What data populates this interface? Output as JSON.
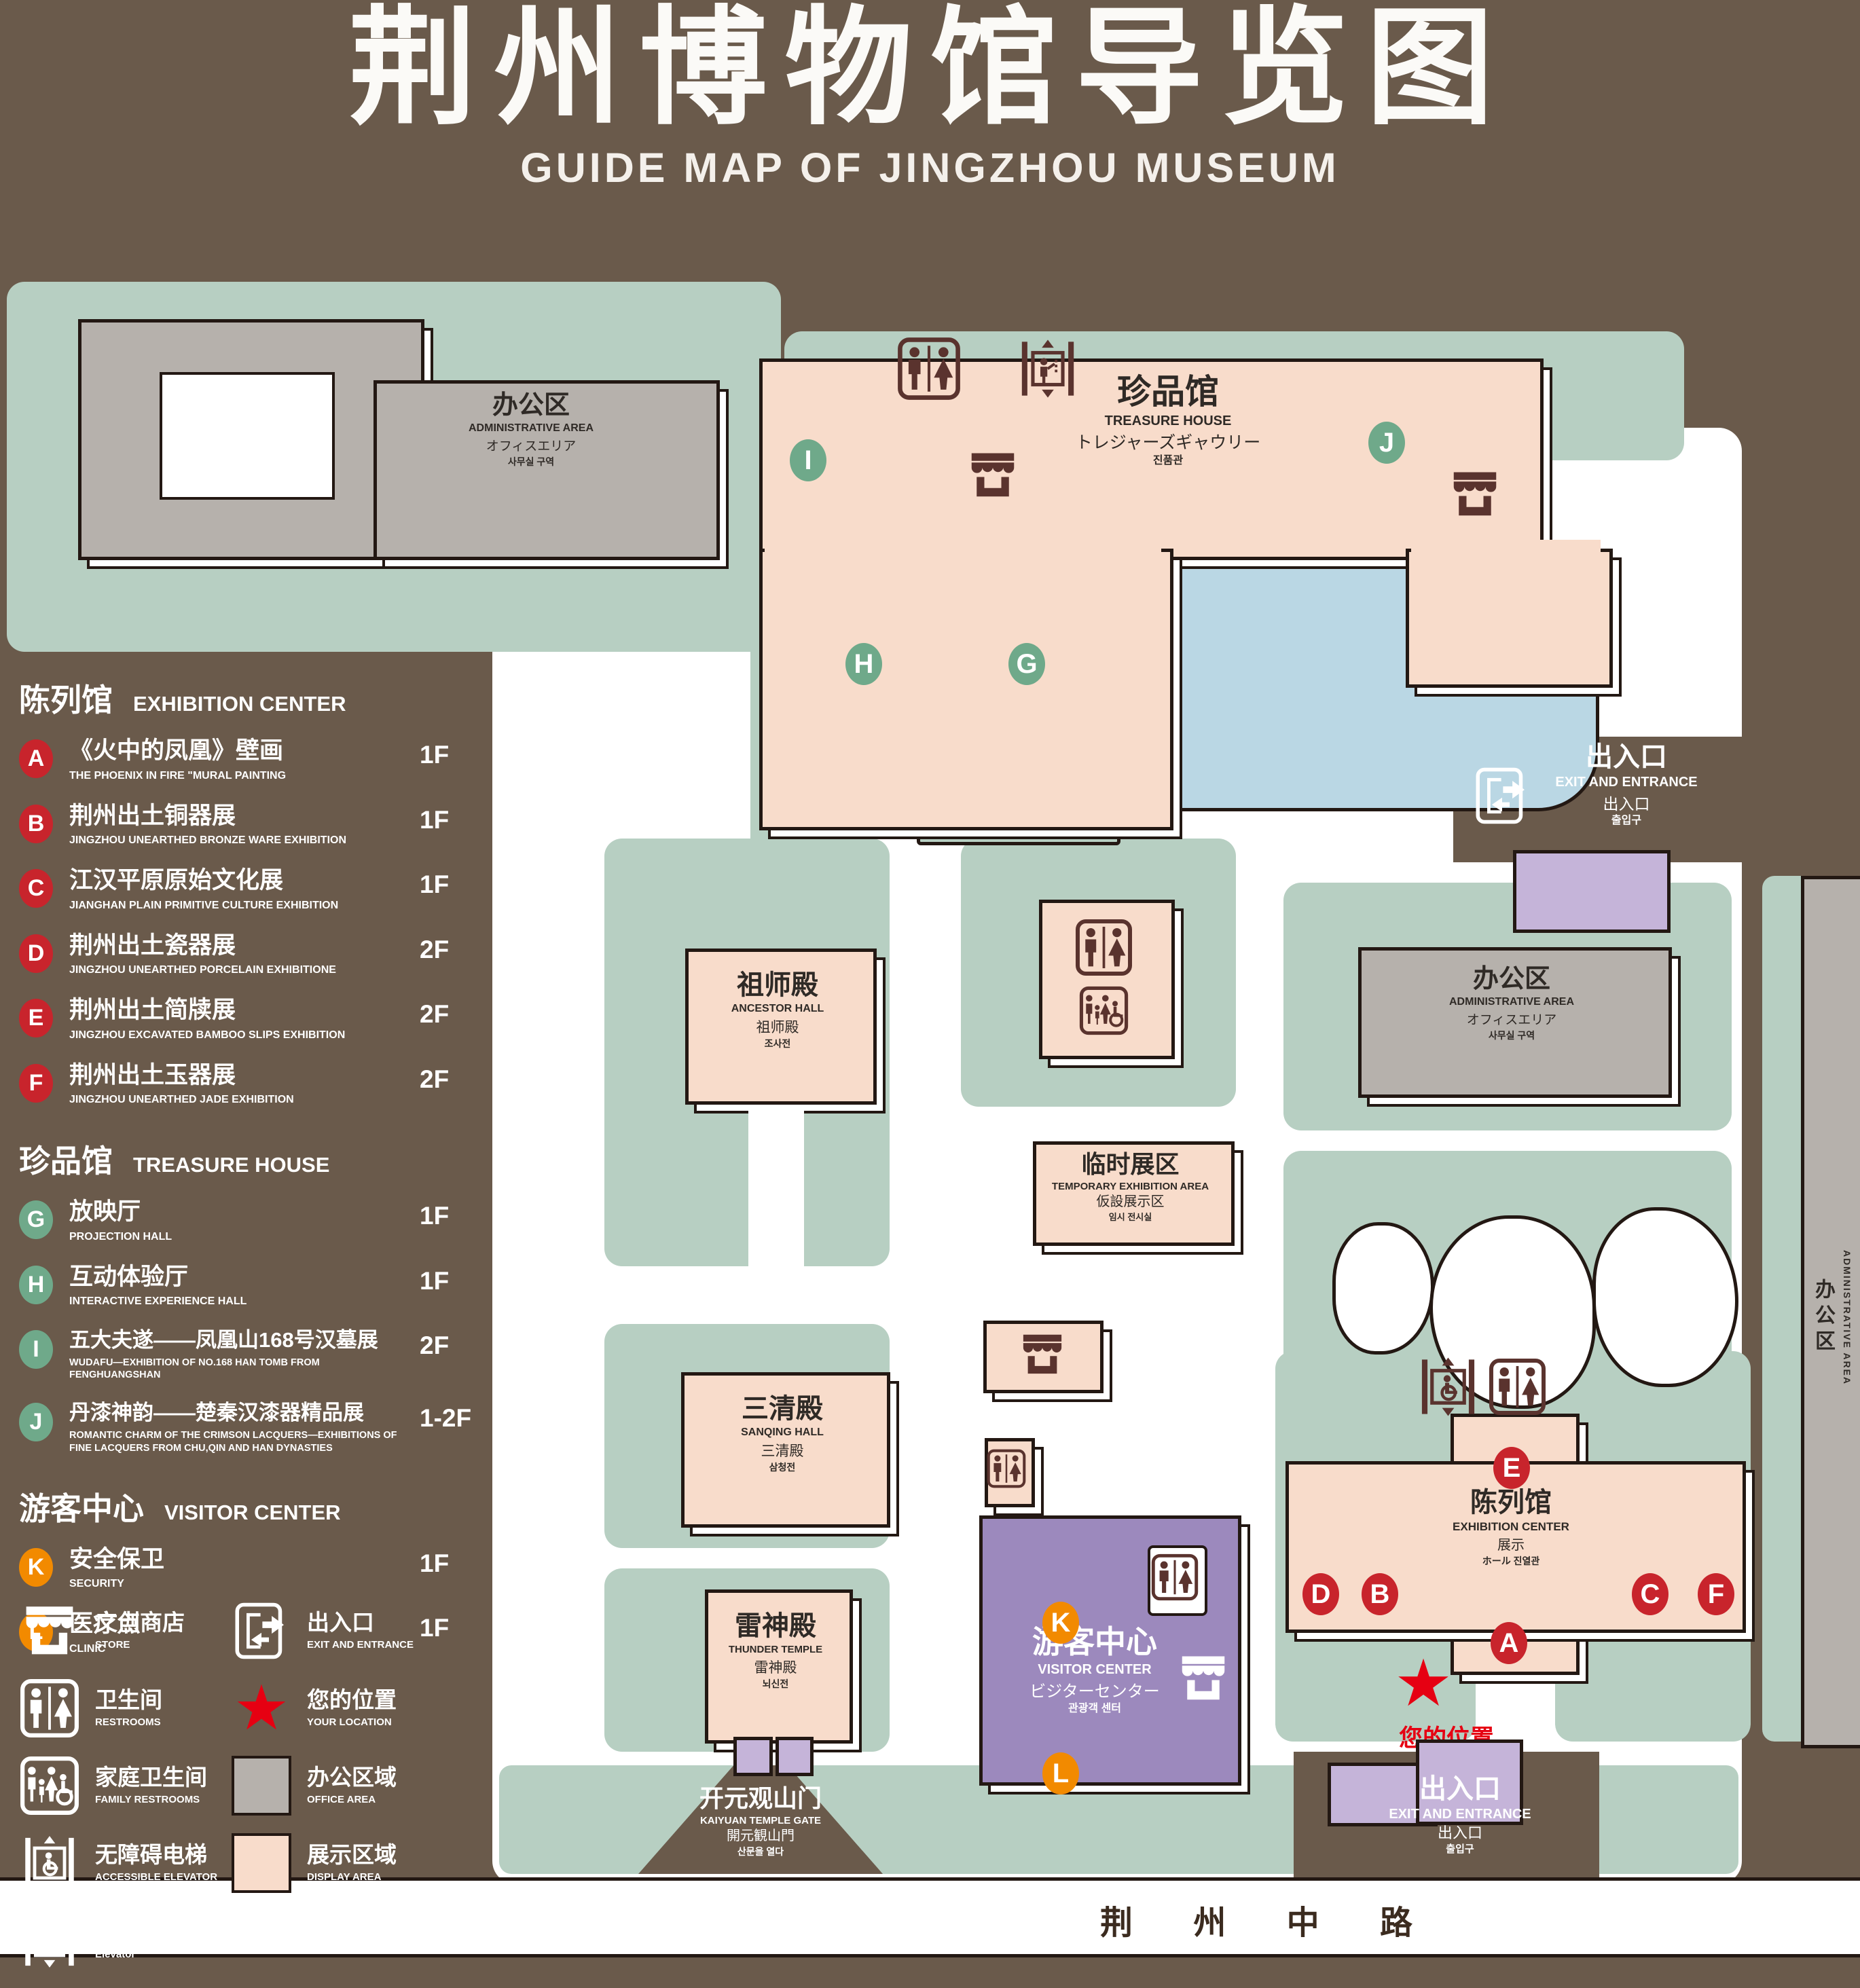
{
  "title": {
    "zh": "荆州博物馆导览图",
    "en": "GUIDE MAP OF JINGZHOU MUSEUM"
  },
  "colors": {
    "background": "#6A5A4B",
    "lawn": "#B7CFC2",
    "display_area": "#F8DCCB",
    "office_area": "#B6B1AC",
    "visitor_center_purple": "#9C89BD",
    "gate_purple": "#C5B4D9",
    "lake_blue": "#BAD7E4",
    "marker_red": "#C8242C",
    "marker_green": "#6FA98A",
    "marker_orange": "#F28A00",
    "location_red": "#E60012",
    "icon_maroon": "#5A332E"
  },
  "legend": {
    "sections": [
      {
        "zh": "陈列馆",
        "en": "EXHIBITION CENTER",
        "marker_color": "#C8242C",
        "items": [
          {
            "letter": "A",
            "zh": "《火中的凤凰》壁画",
            "en": "THE PHOENIX IN FIRE \"MURAL PAINTING",
            "floor": "1F"
          },
          {
            "letter": "B",
            "zh": "荆州出土铜器展",
            "en": "JINGZHOU UNEARTHED BRONZE WARE EXHIBITION",
            "floor": "1F"
          },
          {
            "letter": "C",
            "zh": "江汉平原原始文化展",
            "en": "JIANGHAN PLAIN PRIMITIVE CULTURE EXHIBITION",
            "floor": "1F"
          },
          {
            "letter": "D",
            "zh": "荆州出土瓷器展",
            "en": "JINGZHOU UNEARTHED PORCELAIN EXHIBITIONE",
            "floor": "2F"
          },
          {
            "letter": "E",
            "zh": "荆州出土简牍展",
            "en": "JINGZHOU EXCAVATED BAMBOO SLIPS EXHIBITION",
            "floor": "2F"
          },
          {
            "letter": "F",
            "zh": "荆州出土玉器展",
            "en": "JINGZHOU UNEARTHED JADE EXHIBITION",
            "floor": "2F"
          }
        ]
      },
      {
        "zh": "珍品馆",
        "en": "TREASURE HOUSE",
        "marker_color": "#6FA98A",
        "items": [
          {
            "letter": "G",
            "zh": "放映厅",
            "en": "PROJECTION HALL",
            "floor": "1F"
          },
          {
            "letter": "H",
            "zh": "互动体验厅",
            "en": "INTERACTIVE EXPERIENCE HALL",
            "floor": "1F"
          },
          {
            "letter": "I",
            "zh": "五大夫遂——凤凰山168号汉墓展",
            "en": "WUDAFU—EXHIBITION OF NO.168 HAN TOMB FROM FENGHUANGSHAN",
            "floor": "2F"
          },
          {
            "letter": "J",
            "zh": "丹漆神韵——楚秦汉漆器精品展",
            "en": "ROMANTIC CHARM OF THE CRIMSON LACQUERS—EXHIBITIONS OF FINE LACQUERS FROM CHU,QIN AND HAN DYNASTIES",
            "floor": "1-2F"
          }
        ]
      },
      {
        "zh": "游客中心",
        "en": "VISITOR CENTER",
        "marker_color": "#F28A00",
        "items": [
          {
            "letter": "K",
            "zh": "安全保卫",
            "en": "SECURITY",
            "floor": "1F"
          },
          {
            "letter": "L",
            "zh": "医疗点",
            "en": "CLINIC",
            "floor": "1F"
          }
        ]
      }
    ],
    "symbols": [
      {
        "icon": "store-icon",
        "zh": "文创商店",
        "en": "STORE"
      },
      {
        "icon": "exit-icon",
        "zh": "出入口",
        "en": "EXIT AND ENTRANCE"
      },
      {
        "icon": "restrooms-icon",
        "zh": "卫生间",
        "en": "RESTROOMS"
      },
      {
        "icon": "your-location-star-icon",
        "zh": "您的位置",
        "en": "YOUR LOCATION"
      },
      {
        "icon": "family-restrooms-icon",
        "zh": "家庭卫生间",
        "en": "FAMILY RESTROOMS"
      },
      {
        "icon": "office-area-swatch",
        "zh": "办公区域",
        "en": "OFFICE AREA"
      },
      {
        "icon": "accessible-elevator-icon",
        "zh": "无障碍电梯",
        "en": "ACCESSIBLE ELEVATOR"
      },
      {
        "icon": "display-area-swatch",
        "zh": "展示区域",
        "en": "DISPLAY AREA"
      },
      {
        "icon": "elevator-icon",
        "zh": "电梯",
        "en": "Elevator"
      }
    ]
  },
  "map": {
    "admin_area": {
      "zh": "办公区",
      "en": "ADMINISTRATIVE AREA",
      "jp": "オフィスエリア",
      "kr": "사무실 구역"
    },
    "treasure_house": {
      "zh": "珍品馆",
      "en": "TREASURE HOUSE",
      "jp": "トレジャーズギャウリー",
      "kr": "진품관"
    },
    "ancestor_hall": {
      "zh": "祖师殿",
      "en": "ANCESTOR HALL",
      "jp": "祖师殿",
      "kr": "조사전"
    },
    "temporary_exhibition": {
      "zh": "临时展区",
      "en": "TEMPORARY EXHIBITION AREA",
      "jp": "仮設展示区",
      "kr": "임시 전시실"
    },
    "sanqing_hall": {
      "zh": "三清殿",
      "en": "SANQING HALL",
      "jp": "三清殿",
      "kr": "삼청전"
    },
    "thunder_temple": {
      "zh": "雷神殿",
      "en": "THUNDER TEMPLE",
      "jp": "雷神殿",
      "kr": "뇌신전"
    },
    "visitor_center": {
      "zh": "游客中心",
      "en": "VISITOR CENTER",
      "jp": "ビジターセンター",
      "kr": "관광객 센터"
    },
    "exhibition_center": {
      "zh": "陈列馆",
      "en": "EXHIBITION CENTER",
      "line3": "展示",
      "line4": "ホール 진열관"
    },
    "gate": {
      "zh": "开元观山门",
      "en": "KAIYUAN TEMPLE GATE",
      "jp": "開元観山門",
      "kr": "산문을 열다"
    },
    "exit": {
      "zh": "出入口",
      "en": "EXIT AND ENTRANCE",
      "jp": "出入口",
      "kr": "출입구"
    },
    "road": "荆 州 中 路",
    "your_location": "您的位置"
  }
}
